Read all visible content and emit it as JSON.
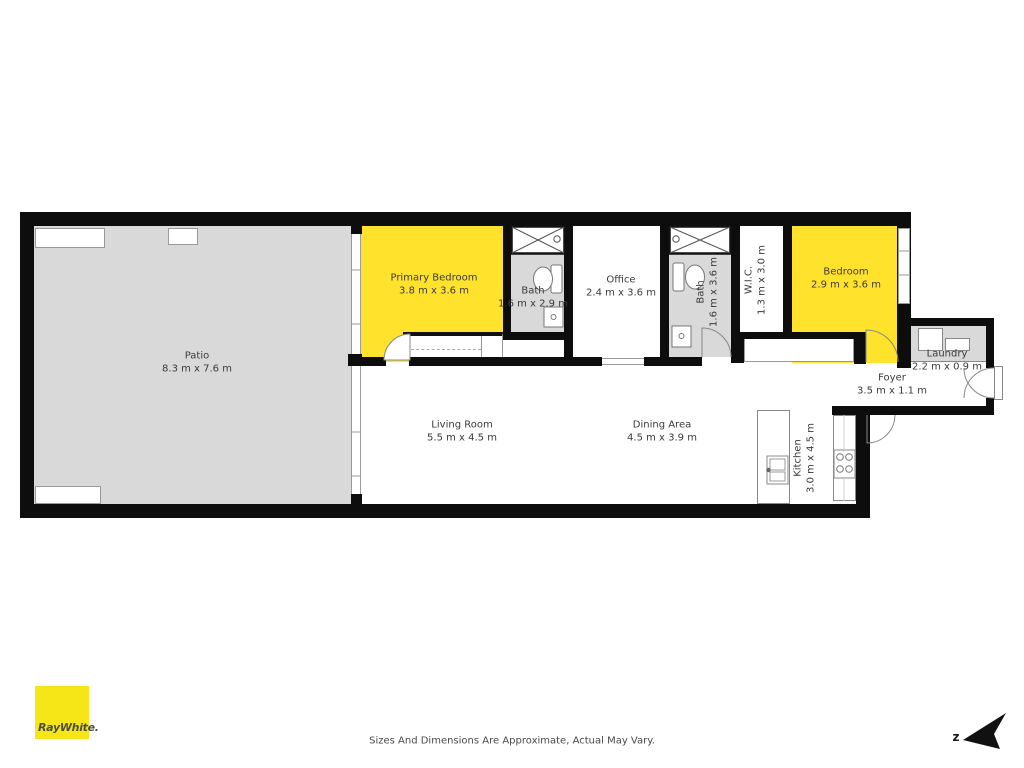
{
  "brand": {
    "logo_text": "RayWhite."
  },
  "footer": {
    "disclaimer": "Sizes And Dimensions Are Approximate, Actual May Vary."
  },
  "compass": {
    "label": "z"
  },
  "palette": {
    "highlight_yellow": "#FFE22C",
    "logo_yellow": "#F7E617",
    "floor_gray": "#D9D9D9",
    "wall_black": "#0D0D0D",
    "label_text": "#3A3A3A"
  },
  "rooms": [
    {
      "id": "patio",
      "name": "Patio",
      "dims": "8.3 m x 7.6 m"
    },
    {
      "id": "primary-bedroom",
      "name": "Primary Bedroom",
      "dims": "3.8 m x 3.6 m"
    },
    {
      "id": "bath-1",
      "name": "Bath",
      "dims": "1.6 m x 2.9 m"
    },
    {
      "id": "office",
      "name": "Office",
      "dims": "2.4 m x 3.6 m"
    },
    {
      "id": "bath-2",
      "name": "Bath",
      "dims": "1.6 m x 3.6 m"
    },
    {
      "id": "wic",
      "name": "W.I.C.",
      "dims": "1.3 m x 3.0 m"
    },
    {
      "id": "bedroom",
      "name": "Bedroom",
      "dims": "2.9 m x 3.6 m"
    },
    {
      "id": "laundry",
      "name": "Laundry",
      "dims": "2.2 m x 0.9 m"
    },
    {
      "id": "foyer",
      "name": "Foyer",
      "dims": "3.5 m x 1.1 m"
    },
    {
      "id": "living-room",
      "name": "Living Room",
      "dims": "5.5 m x 4.5 m"
    },
    {
      "id": "dining-area",
      "name": "Dining Area",
      "dims": "4.5 m x 3.9 m"
    },
    {
      "id": "kitchen",
      "name": "Kitchen",
      "dims": "3.0 m x 4.5 m"
    }
  ]
}
